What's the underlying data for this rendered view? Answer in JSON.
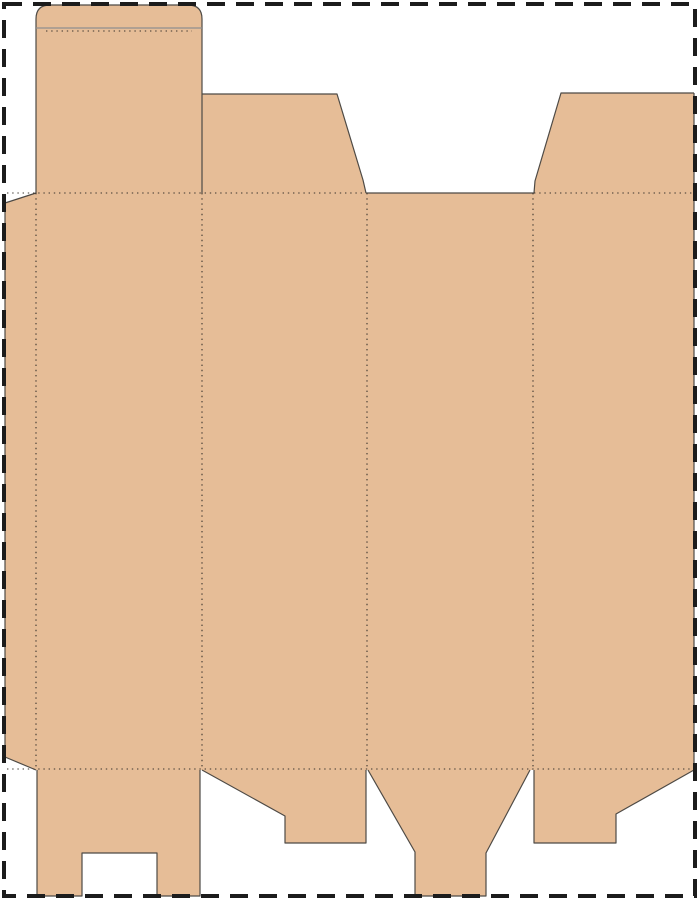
{
  "meta": {
    "description": "folding-box dieline template",
    "canvas": {
      "width": 699,
      "height": 900,
      "background": "#ffffff"
    }
  },
  "colors": {
    "cardboard": "#e6bd97",
    "cut_line": "#4e4a45",
    "fold_line": "#3a342e",
    "shoulder_line": "#8f8f8f",
    "page_border": "#1c1c1c"
  },
  "page_border": {
    "x": 4,
    "y": 4,
    "width": 691,
    "height": 892,
    "thickness": 4,
    "dash": 18,
    "gap": 11
  },
  "panels": [
    {
      "name": "tuck-flap-top",
      "path": "M 36 193 L 36 19 Q 36 5 50 5 L 188 5 Q 202 5 202 19 L 202 193 Z"
    },
    {
      "name": "dust-flap-left",
      "path": "M 202 193 L 202 94 L 337 94 L 363 180 L 366 193 Z"
    },
    {
      "name": "dust-flap-right",
      "path": "M 534 193 L 535 181 L 561 93 L 694 93 L 694 193 Z"
    },
    {
      "name": "main-body",
      "path": "M 5 203 L 36 193 L 694 193 L 694 770 L 36 770 L 5 757 Z"
    },
    {
      "name": "bottom-flap-1",
      "path": "M 37 770 L 200 770 L 200 896 L 157 896 L 157 853 L 82 853 L 82 896 L 37 896 Z"
    },
    {
      "name": "bottom-flap-2",
      "path": "M 202 770 L 366 770 L 366 843 L 285 843 L 285 816 Z"
    },
    {
      "name": "bottom-flap-3",
      "path": "M 368 770 L 530 770 L 486 853 L 486 896 L 415 896 L 415 852 Z"
    },
    {
      "name": "bottom-flap-4",
      "path": "M 534 770 L 694 770 L 616 814 L 616 843 L 534 843 Z"
    }
  ],
  "cut_lines": [
    {
      "name": "tuck-flap-outline",
      "stroke": "cut_line",
      "path": "M 36 193 L 36 19 Q 36 5 50 5 L 188 5 Q 202 5 202 19 L 202 193"
    },
    {
      "name": "tuck-flap-shoulder-line",
      "stroke": "shoulder_line",
      "path": "M 36 28 L 202 28"
    },
    {
      "name": "dust-flap-left-outline",
      "stroke": "cut_line",
      "path": "M 202 94 L 337 94 L 363 180 L 366 193"
    },
    {
      "name": "dust-flap-right-outline",
      "stroke": "cut_line",
      "path": "M 694 93 L 561 93 L 535 181 L 534 193"
    },
    {
      "name": "body-right-edge",
      "stroke": "cut_line",
      "path": "M 694 93 L 694 770"
    },
    {
      "name": "glue-flap-outline",
      "stroke": "cut_line",
      "path": "M 36 193 L 5 203 L 5 757 L 36 770"
    },
    {
      "name": "body-top-exposed-edge",
      "stroke": "cut_line",
      "path": "M 367 193 L 534 193"
    },
    {
      "name": "bottom-flap-1-outline",
      "stroke": "cut_line",
      "path": "M 37 770 L 37 896 L 82 896 L 82 853 L 157 853 L 157 896 L 200 896 L 200 770"
    },
    {
      "name": "bottom-flap-2-outline",
      "stroke": "cut_line",
      "path": "M 202 770 L 285 816 L 285 843 L 366 843 L 366 770"
    },
    {
      "name": "bottom-flap-3-outline",
      "stroke": "cut_line",
      "path": "M 368 770 L 415 852 L 415 896 L 486 896 L 486 853 L 530 770"
    },
    {
      "name": "bottom-flap-4-outline",
      "stroke": "cut_line",
      "path": "M 534 770 L 534 843 L 616 843 L 616 814 L 694 770"
    }
  ],
  "fold_lines": [
    {
      "name": "tuck-flap-fold",
      "path": "M 46 31 L 192 31"
    },
    {
      "name": "top-fold-left",
      "path": "M 7 193 L 367 193"
    },
    {
      "name": "top-fold-right",
      "path": "M 534 193 L 694 193"
    },
    {
      "name": "bottom-fold",
      "path": "M 7 769 L 694 769"
    },
    {
      "name": "glue-flap-fold",
      "path": "M 36 193 L 36 769"
    },
    {
      "name": "panel-fold-1",
      "path": "M 202 193 L 202 769"
    },
    {
      "name": "panel-fold-2",
      "path": "M 367 193 L 367 769"
    },
    {
      "name": "panel-fold-3",
      "path": "M 533 193 L 533 769"
    }
  ],
  "line_style": {
    "cut_width": 1.2,
    "fold_width": 1.1,
    "fold_dash": "1.4 3.8"
  }
}
